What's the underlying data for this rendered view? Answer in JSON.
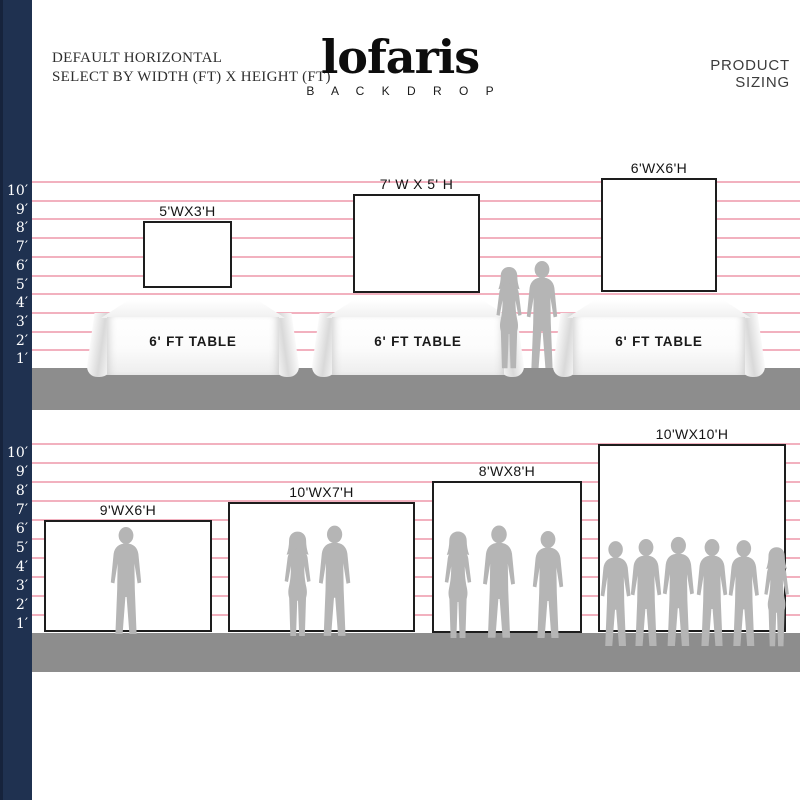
{
  "header": {
    "left_line1": "DEFAULT HORIZONTAL",
    "left_line2": "SELECT BY WIDTH (FT) X HEIGHT (FT)",
    "right": "PRODUCT SIZING"
  },
  "logo": {
    "name": "lofaris",
    "subtitle": "B A C K D R O P"
  },
  "ruler": {
    "labels": [
      "10′",
      "9′",
      "8′",
      "7′",
      "6′",
      "5′",
      "4′",
      "3′",
      "2′",
      "1′"
    ]
  },
  "top_row": {
    "backdrops": [
      {
        "label": "5'WX3'H",
        "width_ft": 5,
        "height_ft": 3
      },
      {
        "label": "7' W X 5' H",
        "width_ft": 7,
        "height_ft": 5
      },
      {
        "label": "6'WX6'H",
        "width_ft": 6,
        "height_ft": 6
      }
    ],
    "tables": [
      {
        "label": "6' FT TABLE"
      },
      {
        "label": "6' FT TABLE"
      },
      {
        "label": "6' FT TABLE"
      }
    ]
  },
  "bottom_row": {
    "backdrops": [
      {
        "label": "9'WX6'H",
        "width_ft": 9,
        "height_ft": 6
      },
      {
        "label": "10'WX7'H",
        "width_ft": 10,
        "height_ft": 7
      },
      {
        "label": "8'WX8'H",
        "width_ft": 8,
        "height_ft": 8
      },
      {
        "label": "10'WX10'H",
        "width_ft": 10,
        "height_ft": 10
      }
    ]
  },
  "colors": {
    "navy_strip": "#1f3150",
    "gridline_pink": "#f0a3b4",
    "floor_grey": "#8d8d8d",
    "silhouette_grey": "#b5b5b5",
    "backdrop_border": "#1d1d1d"
  }
}
